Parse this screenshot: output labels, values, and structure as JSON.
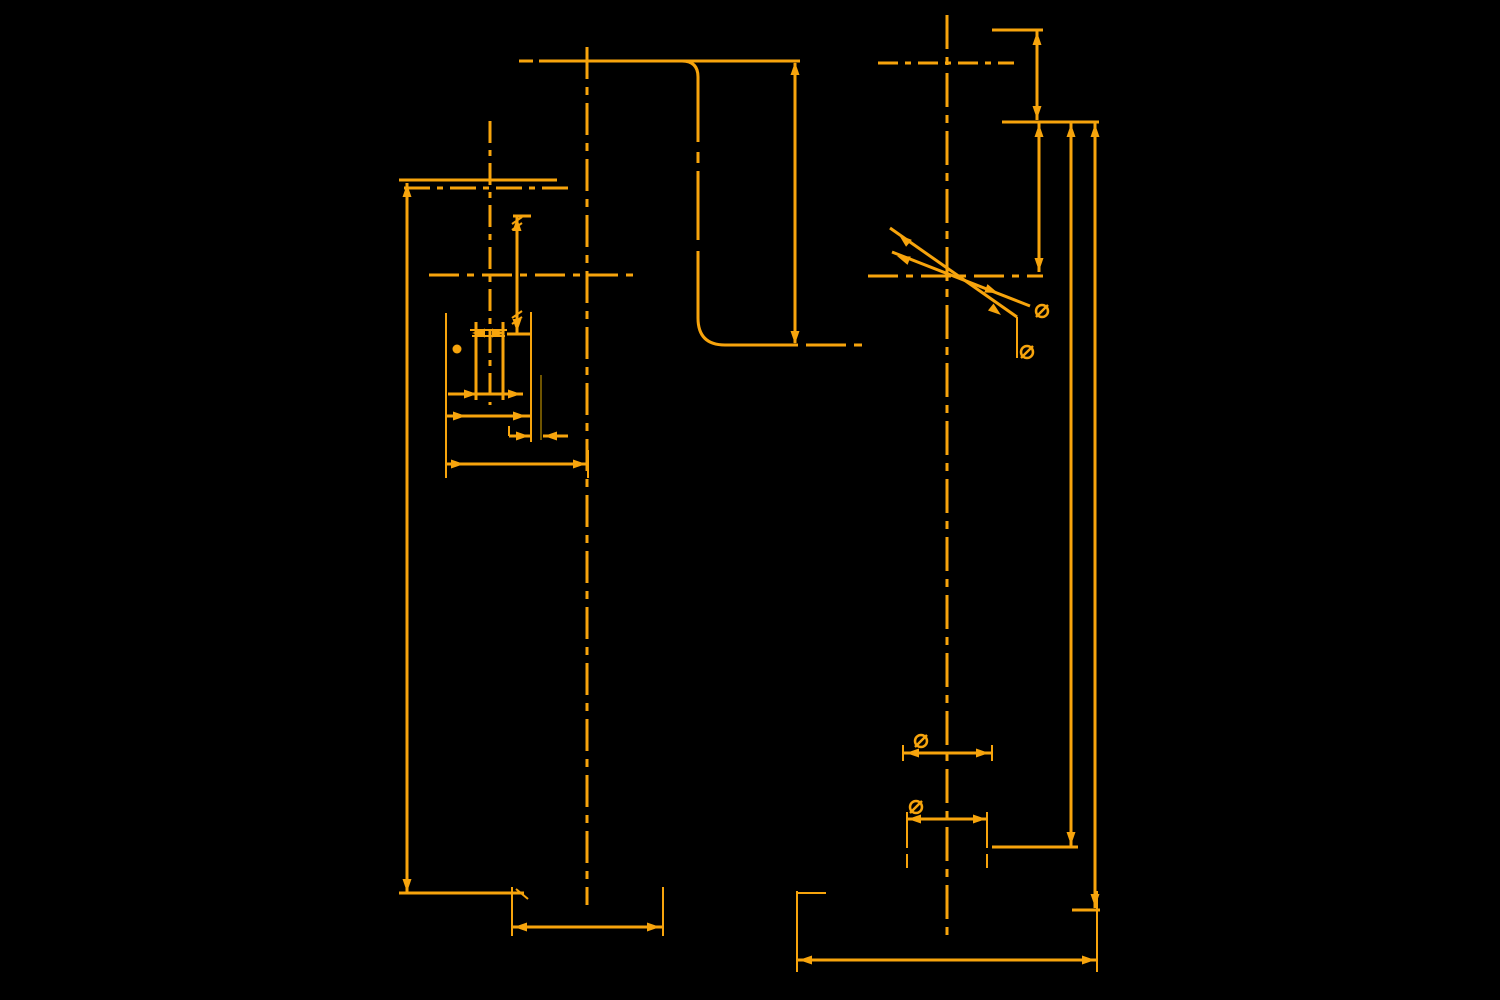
{
  "canvas": {
    "width": 1500,
    "height": 1000,
    "background": "#000000",
    "stroke_color": "#F7A40C",
    "dark_stroke_color": "#6E5400",
    "default_line_width": 3,
    "arrow_length": 13,
    "arrow_halfwidth": 4.5,
    "diameter_symbol_radius": 6
  },
  "figures": [
    {
      "name": "left-view",
      "lines": [
        [
          399,
          180,
          557,
          180
        ],
        [
          404,
          188,
          571,
          188,
          "26 7 6 7"
        ],
        [
          407,
          183,
          407,
          893
        ],
        [
          490,
          121,
          490,
          405,
          "22 7 6 7"
        ],
        [
          429,
          275,
          633,
          275,
          "30 8 7 8"
        ],
        [
          587,
          47,
          587,
          905,
          "32 8 8 8"
        ],
        [
          513,
          216,
          531,
          216
        ],
        [
          517,
          216,
          517,
          334
        ],
        [
          507,
          334,
          531,
          334
        ],
        [
          476,
          322,
          476,
          400
        ],
        [
          503,
          322,
          503,
          400
        ],
        [
          470,
          330,
          507,
          330,
          null,
          2
        ],
        [
          472,
          336,
          505,
          336,
          null,
          2
        ],
        [
          448,
          394,
          523,
          394
        ],
        [
          447,
          416,
          531,
          416
        ],
        [
          509,
          426,
          509,
          436,
          null,
          2
        ],
        [
          509,
          436,
          531,
          436
        ],
        [
          543,
          436,
          568,
          436
        ],
        [
          531,
          312,
          531,
          442,
          null,
          2
        ],
        [
          541,
          375,
          541,
          440,
          null,
          2,
          "dark"
        ],
        [
          446,
          464,
          588,
          464
        ],
        [
          446,
          313,
          446,
          478,
          null,
          2
        ],
        [
          588,
          450,
          588,
          478,
          null,
          2
        ],
        [
          399,
          893,
          524,
          893
        ],
        [
          516,
          889,
          528,
          899,
          null,
          2
        ],
        [
          512,
          887,
          512,
          936,
          null,
          2
        ],
        [
          512,
          927,
          663,
          927
        ],
        [
          663,
          887,
          663,
          936,
          null,
          2
        ],
        [
          512,
          224,
          522,
          217,
          null,
          2
        ],
        [
          512,
          230,
          522,
          223,
          null,
          2
        ],
        [
          512,
          318,
          522,
          311,
          null,
          2
        ],
        [
          512,
          324,
          522,
          317,
          null,
          2
        ]
      ],
      "paths": [],
      "arrows": [
        [
          407,
          184,
          -90
        ],
        [
          407,
          892,
          90
        ],
        [
          517,
          218,
          -90
        ],
        [
          517,
          332,
          90
        ],
        [
          472,
          333,
          180
        ],
        [
          505,
          333,
          0
        ],
        [
          477,
          394,
          0
        ],
        [
          521,
          394,
          0
        ],
        [
          466,
          416,
          0
        ],
        [
          526,
          416,
          0
        ],
        [
          529,
          436,
          0
        ],
        [
          544,
          436,
          180
        ],
        [
          464,
          464,
          0
        ],
        [
          586,
          464,
          0
        ],
        [
          514,
          927,
          180
        ],
        [
          660,
          927,
          0
        ]
      ],
      "dots": [
        [
          457,
          349,
          4.5
        ]
      ],
      "dia_symbols": []
    },
    {
      "name": "middle-profile",
      "lines": [
        [
          519,
          61,
          533,
          61
        ],
        [
          539,
          61,
          800,
          61
        ],
        [
          698,
          77,
          698,
          142
        ],
        [
          698,
          152,
          698,
          163
        ],
        [
          698,
          171,
          698,
          240
        ],
        [
          698,
          251,
          698,
          318
        ],
        [
          725,
          345,
          798,
          345
        ],
        [
          806,
          345,
          846,
          345
        ],
        [
          854,
          345,
          862,
          345
        ],
        [
          795,
          63,
          795,
          343
        ]
      ],
      "paths": [
        "M682,61 Q698,61 698,77",
        "M698,318 Q698,345 725,345"
      ],
      "arrows": [
        [
          795,
          62,
          -90
        ],
        [
          795,
          344,
          90
        ]
      ],
      "dots": [],
      "dia_symbols": []
    },
    {
      "name": "right-view",
      "lines": [
        [
          947,
          15,
          947,
          938,
          "34 8 8 8"
        ],
        [
          878,
          63,
          1014,
          63,
          "20 7 6 7"
        ],
        [
          992,
          30,
          1043,
          30
        ],
        [
          1037,
          31,
          1037,
          120
        ],
        [
          1002,
          122,
          1099,
          122
        ],
        [
          1039,
          123,
          1039,
          272
        ],
        [
          1071,
          123,
          1071,
          846
        ],
        [
          1095,
          123,
          1095,
          908
        ],
        [
          868,
          276,
          1043,
          276,
          "30 8 7 8"
        ],
        [
          890,
          228,
          1017,
          317
        ],
        [
          1017,
          317,
          1017,
          358,
          null,
          2
        ],
        [
          892,
          252,
          1030,
          306
        ],
        [
          904,
          753,
          991,
          753
        ],
        [
          903,
          745,
          903,
          761,
          null,
          2
        ],
        [
          992,
          745,
          992,
          761,
          null,
          2
        ],
        [
          906,
          819,
          988,
          819
        ],
        [
          907,
          812,
          907,
          848,
          null,
          2
        ],
        [
          907,
          854,
          907,
          868,
          null,
          2
        ],
        [
          987,
          812,
          987,
          848,
          null,
          2
        ],
        [
          987,
          854,
          987,
          868,
          null,
          2
        ],
        [
          992,
          847,
          1078,
          847
        ],
        [
          1072,
          910,
          1100,
          910
        ],
        [
          797,
          891,
          797,
          972,
          null,
          2
        ],
        [
          1097,
          891,
          1097,
          972,
          null,
          2
        ],
        [
          797,
          960,
          1097,
          960
        ],
        [
          798,
          893,
          826,
          893,
          null,
          2
        ]
      ],
      "paths": [],
      "arrows": [
        [
          1037,
          32,
          -90
        ],
        [
          1037,
          119,
          90
        ],
        [
          1039,
          124,
          -90
        ],
        [
          1039,
          271,
          90
        ],
        [
          1071,
          124,
          -90
        ],
        [
          1071,
          845,
          90
        ],
        [
          1095,
          124,
          -90
        ],
        [
          1095,
          907,
          90
        ],
        [
          899,
          235,
          -140
        ],
        [
          1001,
          315,
          38
        ],
        [
          897,
          256,
          -159
        ],
        [
          998,
          293,
          21
        ],
        [
          906,
          753,
          180
        ],
        [
          989,
          753,
          0
        ],
        [
          908,
          819,
          180
        ],
        [
          986,
          819,
          0
        ],
        [
          799,
          960,
          180
        ],
        [
          1095,
          960,
          0
        ]
      ],
      "dots": [],
      "dia_symbols": [
        [
          921,
          741
        ],
        [
          916,
          807
        ],
        [
          1027,
          352
        ],
        [
          1042,
          311
        ]
      ]
    }
  ]
}
